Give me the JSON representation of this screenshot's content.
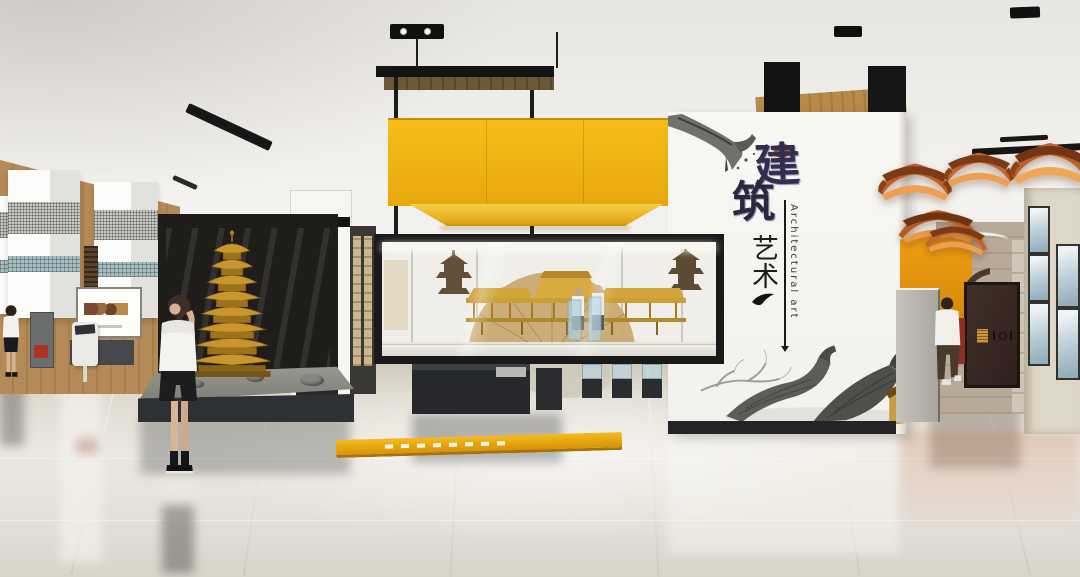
{
  "panel": {
    "title_chars": [
      "建",
      "筑"
    ],
    "subtitle_chars": [
      "艺",
      "术"
    ],
    "english_label": "Architectural art"
  },
  "colors": {
    "accent_yellow": "#f3b514",
    "eave_orange": "#bf5f2a",
    "calligraphy_ink": "#322e4f",
    "calligraphy_red": "#a63b2a",
    "pagoda_gold": "#c9952f",
    "frame_black": "#1b1b1b",
    "floor_strip_yellow": "#eeb215",
    "orange_wall": "#f2a116"
  }
}
